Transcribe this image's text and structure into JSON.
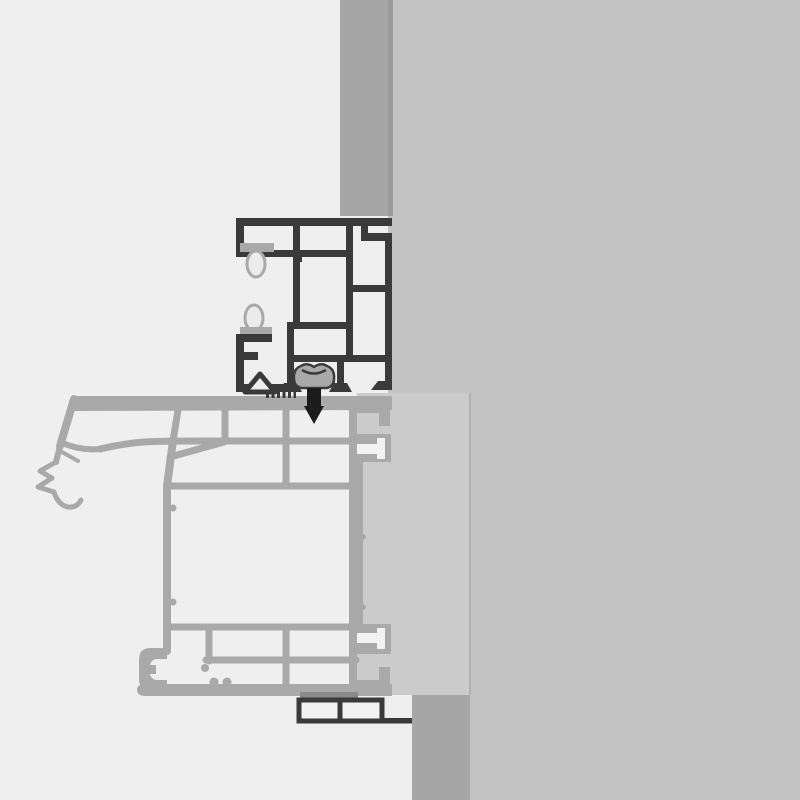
{
  "title": "Window frame installation cross-section detail drawing",
  "drawing_type": "technical-cad-cross-section",
  "colors": {
    "bg": "#efefef",
    "wall": "#c3c3c3",
    "render_strip": "#a6a6a6",
    "wall_edge": "#9a9a9a",
    "panel": "#cbcbcb",
    "panel_edge": "#b2b2b2",
    "profile_gray": "#a9a9a9",
    "profile_dark": "#3a3a3a",
    "gasket_fill": "#ececec",
    "seal_dark": "#8a8a8a",
    "screw_dark": "#1c1c1c",
    "frame_fill": "#f2f2f2"
  },
  "components": {
    "masonry_wall": "masonry wall (right, grey)",
    "render_strip_top": "exterior render layer strip above frame",
    "render_strip_bottom": "exterior render layer strip below sill",
    "insulation_panel": "insulation / mounting panel beside frame",
    "dark_profile": "outer frame extension profile (dark multi-chamber cross-section)",
    "gasket_upper": "upper sealing gasket bulb",
    "gasket_lower": "lower sealing gasket bulb",
    "fastening_screw": "self-tapping fastening screw through profiles",
    "grey_profile": "window frame multi-chamber profile (grey cross-section)",
    "exterior_gasket_claw": "exterior co-extruded gasket lip at left end",
    "anchor_port_upper": "upper T-slot anchor connector into panel",
    "anchor_port_lower": "lower T-slot anchor connector into panel",
    "glazing_clip": "bottom-left clip chamber",
    "seal_tape": "compression seal tape under frame",
    "sill_connector": "sill adapter profile (dark outline, two chambers)"
  }
}
